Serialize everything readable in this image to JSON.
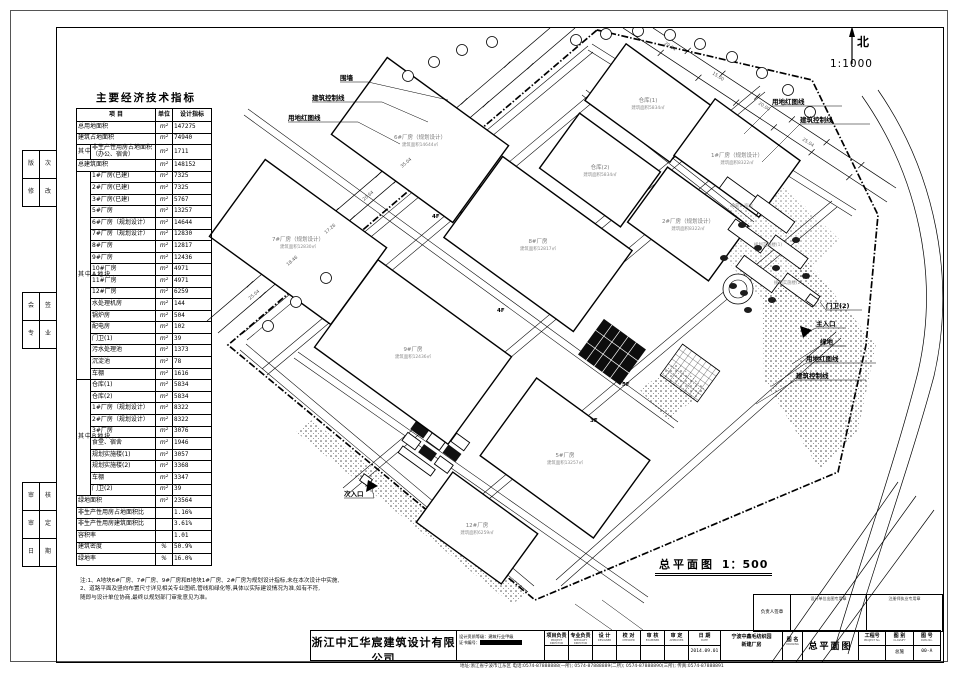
{
  "meta": {
    "north": "北",
    "scale_plan": "1:1000",
    "caption": "总平面图",
    "caption_scale": "1：500"
  },
  "indicator_table": {
    "title": "主要经济技术指标",
    "headers": [
      "项  目",
      "单位",
      "设计指标"
    ],
    "groups": {
      "mid": "其中",
      "A": "其中A地块",
      "B": "其中B地块"
    },
    "rows": [
      {
        "name": "总用地面积",
        "unit": "m²",
        "value": "147275"
      },
      {
        "name": "建筑占地面积",
        "unit": "m²",
        "value": "74940"
      },
      {
        "name": "非生产性用房占地面积\n（办公、宿舍）",
        "unit": "m²",
        "value": "1711",
        "grp": "mid"
      },
      {
        "name": "总建筑面积",
        "unit": "m²",
        "value": "148152"
      },
      {
        "name": "1#厂房(已建)",
        "unit": "m²",
        "value": "7325",
        "grp": "A"
      },
      {
        "name": "2#厂房(已建)",
        "unit": "m²",
        "value": "7325",
        "grp": "A"
      },
      {
        "name": "3#厂房(已建)",
        "unit": "m²",
        "value": "5767",
        "grp": "A"
      },
      {
        "name": "5#厂房",
        "unit": "m²",
        "value": "13257",
        "grp": "A"
      },
      {
        "name": "6#厂房（规划设计）",
        "unit": "m²",
        "value": "14644",
        "grp": "A"
      },
      {
        "name": "7#厂房（规划设计）",
        "unit": "m²",
        "value": "12830",
        "grp": "A"
      },
      {
        "name": "8#厂房",
        "unit": "m²",
        "value": "12817",
        "grp": "A"
      },
      {
        "name": "9#厂房",
        "unit": "m²",
        "value": "12436",
        "grp": "A"
      },
      {
        "name": "10#厂房",
        "unit": "m²",
        "value": "4971",
        "grp": "A"
      },
      {
        "name": "11#厂房",
        "unit": "m²",
        "value": "4971",
        "grp": "A"
      },
      {
        "name": "12#厂房",
        "unit": "m²",
        "value": "6259",
        "grp": "A"
      },
      {
        "name": "水处理机房",
        "unit": "m²",
        "value": "144",
        "grp": "A"
      },
      {
        "name": "锅炉房",
        "unit": "m²",
        "value": "504",
        "grp": "A"
      },
      {
        "name": "配电房",
        "unit": "m²",
        "value": "102",
        "grp": "A"
      },
      {
        "name": "门卫(1)",
        "unit": "m²",
        "value": "39",
        "grp": "A"
      },
      {
        "name": "污水处理池",
        "unit": "m²",
        "value": "1373",
        "grp": "A"
      },
      {
        "name": "沉淀池",
        "unit": "m²",
        "value": "78",
        "grp": "A"
      },
      {
        "name": "车棚",
        "unit": "m²",
        "value": "1616",
        "grp": "A"
      },
      {
        "name": "仓库(1)",
        "unit": "m²",
        "value": "5834",
        "grp": "B"
      },
      {
        "name": "仓库(2)",
        "unit": "m²",
        "value": "5834",
        "grp": "B"
      },
      {
        "name": "1#厂房（规划设计）",
        "unit": "m²",
        "value": "8322",
        "grp": "B"
      },
      {
        "name": "2#厂房（规划设计）",
        "unit": "m²",
        "value": "8322",
        "grp": "B"
      },
      {
        "name": "3#厂房",
        "unit": "m²",
        "value": "3076",
        "grp": "B"
      },
      {
        "name": "食堂、宿舍",
        "unit": "m²",
        "value": "1946",
        "grp": "B"
      },
      {
        "name": "规划实施楼(1)",
        "unit": "m²",
        "value": "3057",
        "grp": "B"
      },
      {
        "name": "规划实施楼(2)",
        "unit": "m²",
        "value": "3368",
        "grp": "B"
      },
      {
        "name": "车棚",
        "unit": "m²",
        "value": "3347",
        "grp": "B"
      },
      {
        "name": "门卫(2)",
        "unit": "m²",
        "value": "39",
        "grp": "B"
      },
      {
        "name": "绿地面积",
        "unit": "m²",
        "value": "23564"
      },
      {
        "name": "非生产性用房占地面积比",
        "unit": "",
        "value": "1.16%"
      },
      {
        "name": "非生产性用房建筑面积比",
        "unit": "",
        "value": "3.61%"
      },
      {
        "name": "容积率",
        "unit": "",
        "value": "1.01"
      },
      {
        "name": "建筑密度",
        "unit": "%",
        "value": "50.9%"
      },
      {
        "name": "绿地率",
        "unit": "%",
        "value": "16.0%"
      }
    ]
  },
  "notes": [
    "注:1、A地块6#厂房、7#厂房、9#厂房和B地块1#厂房、2#厂房为规划设计指标,未在本次设计中实施,",
    "    2、道路平面及竖向布置尺寸详见相关专业图纸,管线和绿化等,具体以实际建设情况为准,如有不符,",
    "       随即与设计单位协商,最终以规划部门审批意见为准。"
  ],
  "plan": {
    "buildings": [
      {
        "name": "6#厂房（规划设计）",
        "area": "14644",
        "cx": 420,
        "cy": 140,
        "w": 150,
        "h": 95
      },
      {
        "name": "7#厂房（规划设计）",
        "area": "12830",
        "cx": 298,
        "cy": 242,
        "w": 150,
        "h": 95
      },
      {
        "name": "8#厂房",
        "area": "12817",
        "cx": 538,
        "cy": 244,
        "w": 160,
        "h": 100
      },
      {
        "name": "9#厂房",
        "area": "12436",
        "cx": 413,
        "cy": 352,
        "w": 165,
        "h": 108
      },
      {
        "name": "5#厂房",
        "area": "13257",
        "cx": 565,
        "cy": 458,
        "w": 140,
        "h": 96
      },
      {
        "name": "12#厂房",
        "area": "6259",
        "cx": 477,
        "cy": 528,
        "w": 105,
        "h": 62
      },
      {
        "name": "仓库(1)",
        "area": "5834",
        "cx": 648,
        "cy": 103,
        "w": 105,
        "h": 70
      },
      {
        "name": "仓库(2)",
        "area": "5834",
        "cx": 600,
        "cy": 170,
        "w": 100,
        "h": 68
      },
      {
        "name": "1#厂房（规划设计）",
        "area": "8322",
        "cx": 737,
        "cy": 158,
        "w": 105,
        "h": 70
      },
      {
        "name": "2#厂房（规划设计）",
        "area": "8322",
        "cx": 688,
        "cy": 224,
        "w": 100,
        "h": 68
      }
    ],
    "small_buildings": [
      {
        "cx": 742,
        "cy": 196,
        "w": 46,
        "h": 14
      },
      {
        "cx": 772,
        "cy": 214,
        "w": 46,
        "h": 14
      },
      {
        "cx": 748,
        "cy": 236,
        "w": 40,
        "h": 13
      },
      {
        "cx": 788,
        "cy": 252,
        "w": 40,
        "h": 13
      },
      {
        "cx": 758,
        "cy": 274,
        "w": 44,
        "h": 14
      },
      {
        "cx": 800,
        "cy": 290,
        "w": 40,
        "h": 13
      },
      {
        "cx": 812,
        "cy": 300,
        "w": 10,
        "h": 8
      },
      {
        "cx": 366,
        "cy": 480,
        "w": 10,
        "h": 8
      }
    ],
    "small_labels": [
      {
        "t": "食堂、宿舍",
        "x": 742,
        "y": 207
      },
      {
        "t": "规划实施楼(1)",
        "x": 768,
        "y": 246
      },
      {
        "t": "规划实施楼(2)",
        "x": 788,
        "y": 284
      }
    ],
    "labels": [
      {
        "t": "围墙",
        "x": 340,
        "y": 80,
        "ax": 368,
        "ay": 82,
        "lx": 448,
        "ly": 100
      },
      {
        "t": "建筑控制线",
        "x": 312,
        "y": 100,
        "ax": 382,
        "ay": 102,
        "lx": 428,
        "ly": 122
      },
      {
        "t": "用地红图线",
        "x": 288,
        "y": 120,
        "ax": 358,
        "ay": 122,
        "lx": 400,
        "ly": 144
      },
      {
        "t": "用地红图线",
        "x": 772,
        "y": 104,
        "ax": 842,
        "ay": 106,
        "lx": 744,
        "ly": 134
      },
      {
        "t": "建筑控制线",
        "x": 800,
        "y": 122,
        "ax": 870,
        "ay": 124,
        "lx": 762,
        "ly": 162
      },
      {
        "t": "门卫(2)",
        "x": 826,
        "y": 308,
        "ax": 862,
        "ay": 310,
        "lx": 820,
        "ly": 302
      },
      {
        "t": "主入口",
        "x": 816,
        "y": 326,
        "ax": 846,
        "ay": 328,
        "lx": 808,
        "ly": 332
      },
      {
        "t": "绿地",
        "x": 820,
        "y": 344,
        "ax": 846,
        "ay": 346,
        "lx": 792,
        "ly": 364
      },
      {
        "t": "用地红图线",
        "x": 806,
        "y": 361,
        "ax": 876,
        "ay": 363,
        "lx": 772,
        "ly": 386
      },
      {
        "t": "建筑控制线",
        "x": 796,
        "y": 378,
        "ax": 866,
        "ay": 380,
        "lx": 756,
        "ly": 404
      },
      {
        "t": "次入口",
        "x": 344,
        "y": 496,
        "ax": 374,
        "ay": 498,
        "lx": 372,
        "ly": 488
      }
    ],
    "dims": [
      {
        "t": "25.04",
        "x": 250,
        "y": 300,
        "r": -40
      },
      {
        "t": "18.46",
        "x": 288,
        "y": 266,
        "r": -40
      },
      {
        "t": "17.26",
        "x": 326,
        "y": 234,
        "r": -40
      },
      {
        "t": "20.64",
        "x": 364,
        "y": 201,
        "r": -40
      },
      {
        "t": "35.04",
        "x": 402,
        "y": 168,
        "r": -40
      },
      {
        "t": "29.84",
        "x": 664,
        "y": 44,
        "r": 33
      },
      {
        "t": "15.00",
        "x": 712,
        "y": 74,
        "r": 33
      },
      {
        "t": "20.00",
        "x": 758,
        "y": 104,
        "r": 33
      },
      {
        "t": "25.04",
        "x": 802,
        "y": 140,
        "r": 33
      }
    ],
    "marks": [
      {
        "t": "4F",
        "x": 497,
        "y": 312
      },
      {
        "t": "4F",
        "x": 432,
        "y": 218
      },
      {
        "t": "3F",
        "x": 590,
        "y": 422
      },
      {
        "t": "5F",
        "x": 622,
        "y": 386
      }
    ]
  },
  "titleblock": {
    "company_cn": "浙江中汇华宸建筑设计有限公司",
    "company_en": "ZHEJIANG ZHONGHUI HUACHEN ARCHITECTURAL DESIGN CO.,LTD",
    "qual_label": "设计资质等级：建筑行业甲级",
    "cert_label": "证书编号：",
    "roles": [
      {
        "cn": "项目负责",
        "en": "PROJECT DIRECTOR",
        "value": ""
      },
      {
        "cn": "专业负责",
        "en": "SPECIALTY DIRECTOR",
        "value": ""
      },
      {
        "cn": "设  计",
        "en": "DESIGNER",
        "value": ""
      },
      {
        "cn": "校  对",
        "en": "CHECKER",
        "value": ""
      },
      {
        "cn": "审  核",
        "en": "EXAMINER",
        "value": ""
      },
      {
        "cn": "审  定",
        "en": "APPROVER",
        "value": ""
      }
    ],
    "date_cn": "日  期",
    "date_en": "DATE",
    "date_value": "2014.09.01",
    "project_line1": "宁波中鑫毛纺织园",
    "project_line2": "新建厂房",
    "drawing_label_cn": "图 名",
    "drawing_label_en": "DRAWING",
    "drawing_name": "总平面图",
    "trio": [
      {
        "cn": "工程号",
        "en": "PROJECT No.",
        "value": ""
      },
      {
        "cn": "图  别",
        "en": "CLASSIFY",
        "value": "总施"
      },
      {
        "cn": "图  号",
        "en": "DWG No.",
        "value": "00-A"
      }
    ],
    "footer": "地址:浙江省宁波市江东区  电话:0574-87888888(一所); 0574-87888889(二所); 0574-87888890(三所);  传真:0574-87888891"
  },
  "stampbox": {
    "owner": "负责人签章",
    "cells": [
      "设计单位出图专用章",
      "注册师执业专用章"
    ]
  },
  "binding_strip": {
    "groups": [
      {
        "top": 150,
        "rows": [
          [
            "版",
            "次"
          ],
          [
            "修",
            "改"
          ]
        ]
      },
      {
        "top": 292,
        "rows": [
          [
            "会",
            "签"
          ],
          [
            "专",
            "业"
          ]
        ]
      },
      {
        "top": 482,
        "rows": [
          [
            "审",
            "核"
          ],
          [
            "审",
            "定"
          ],
          [
            "日",
            "期"
          ]
        ]
      }
    ]
  }
}
